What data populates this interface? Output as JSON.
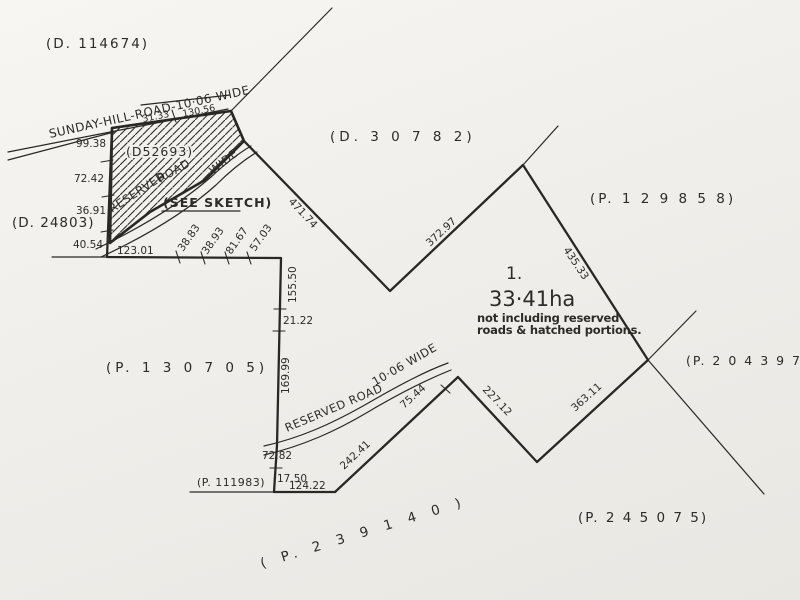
{
  "plan": {
    "parcel_labels": {
      "d114674": "(D. 114674)",
      "d30782": "(D. 3 0 7 8 2)",
      "p129858": "(P. 1 2 9 8 5 8)",
      "d24803": "(D. 24803)",
      "d52693": "(D52693)",
      "p130705": "(P. 1 3 0 7 0 5)",
      "p204397": "(P. 2 0 4 3 9 7)",
      "p111983": "(P. 111983)",
      "p245075": "(P. 2 4 5 0 7 5)",
      "p239140": "( P. 2 3 9 1 4 0 )"
    },
    "lot": {
      "number": "1.",
      "area": "33·41ha",
      "note1": "not including reserved",
      "note2": "roads & hatched portions."
    },
    "roads": {
      "sunday_hill": "SUNDAY-HILL-ROAD-10·06 WIDE",
      "reserved_upper_1": "RESERVED",
      "reserved_upper_2": "ROAD",
      "reserved_upper_3": "WIDE",
      "see_sketch": "(SEE SKETCH)",
      "reserved_lower_1": "RESERVED  ROAD",
      "reserved_lower_2": "10·06 WIDE"
    },
    "measurements": {
      "m9938": "99.38",
      "m7242": "72.42",
      "m3691": "36.91",
      "m4054": "40.54",
      "m12301": "123.01",
      "m3133": "31.33",
      "m13056": "130.56",
      "m3883": "38.83",
      "m3893": "38.93",
      "m8167": "81.67",
      "m5703": "57.03",
      "m15550": "155.50",
      "m2122": "21.22",
      "m16999": "169.99",
      "m7282": "72.82",
      "m1750": "17.50",
      "m12422": "124.22",
      "m24241": "242.41",
      "m7544": "75.44",
      "m22712": "227.12",
      "m36311": "363.11",
      "m43533": "435.33",
      "m37297": "372.97",
      "m47174": "471.74"
    }
  }
}
